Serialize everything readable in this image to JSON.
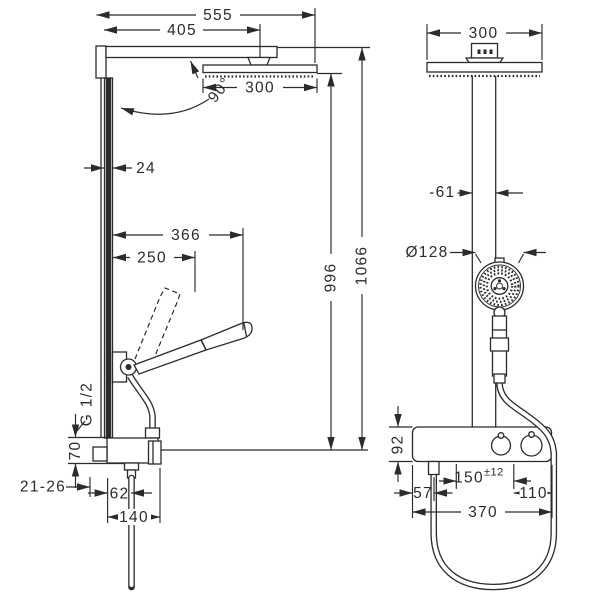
{
  "drawing": {
    "type": "technical dimension drawing",
    "subject": "thermostatic showerpipe with overhead shower and hand shower",
    "background": "#ffffff",
    "line_color": "#2b2b2b",
    "views": [
      "side view",
      "front view"
    ]
  },
  "dims": {
    "side": {
      "total_projection": "555",
      "projection_to_head_center": "405",
      "head_size": "300",
      "arm_angle": "90°",
      "pipe_depth": "24",
      "handshower_reach": "366",
      "handshower_raised_reach": "250",
      "height_to_head_face": "996",
      "height_overall": "1066",
      "thread": "G 1/2",
      "valve_height": "70",
      "wall_depth_range": "21-26",
      "hose_outlet_offset": "62",
      "valve_depth": "140"
    },
    "front": {
      "head_size": "300",
      "pipe_width": "61",
      "handshower_diameter": "Ø128",
      "bar_height": "92",
      "hose_to_bar_edge": "57",
      "supply_spacing": "150",
      "supply_spacing_tolerance": "±12",
      "supply_to_bar_edge": "110",
      "bar_width": "370"
    }
  }
}
